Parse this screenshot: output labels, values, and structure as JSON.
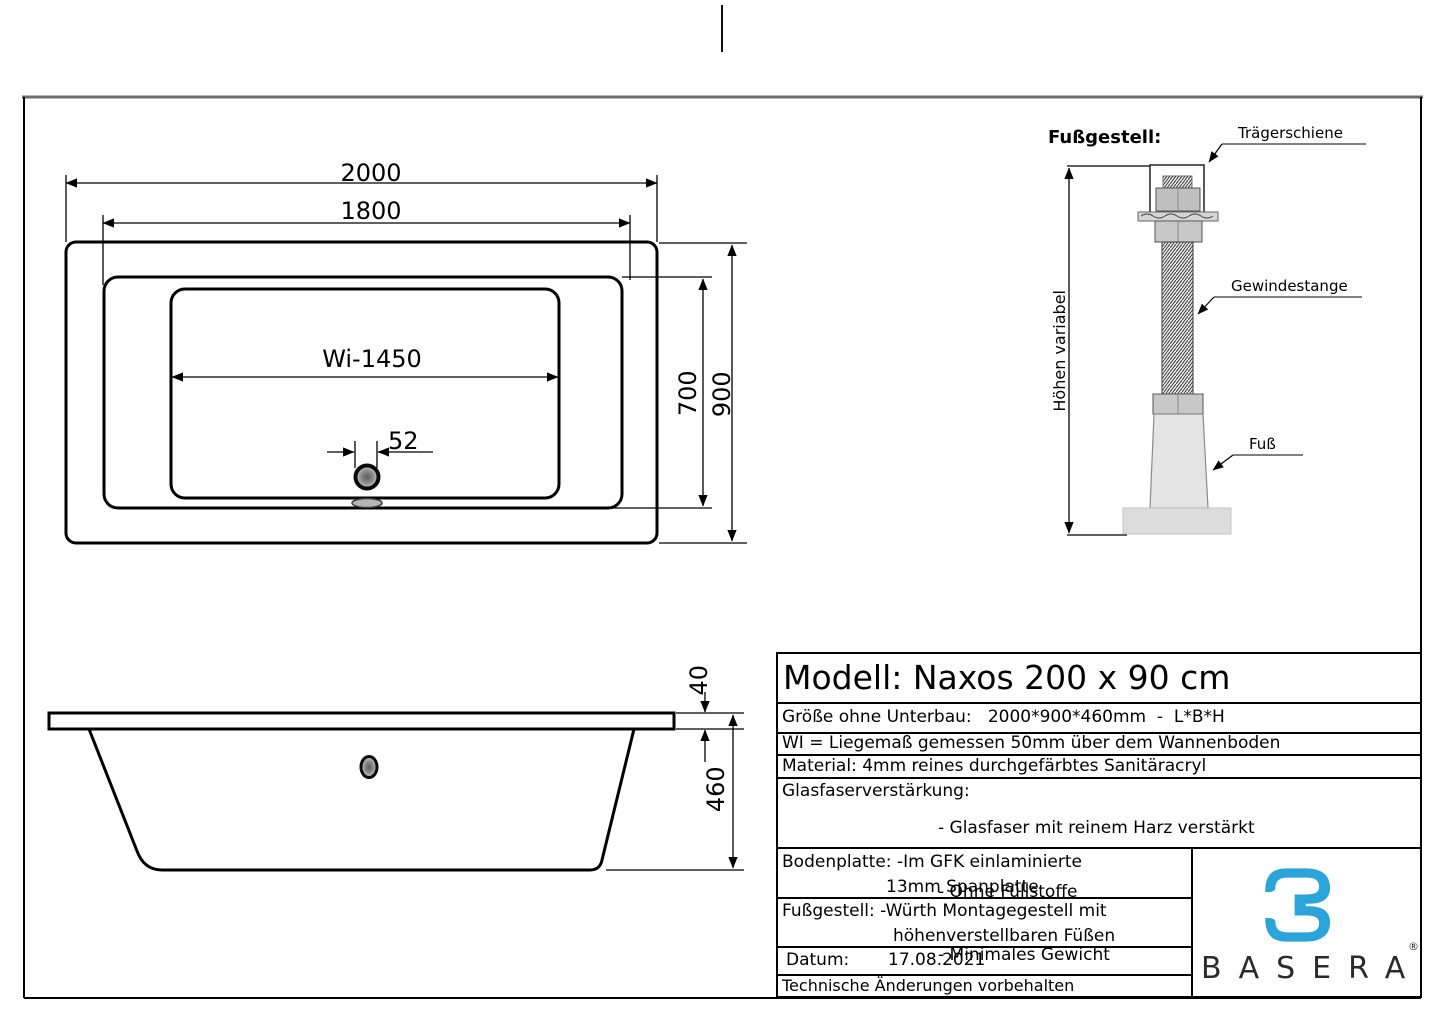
{
  "top_view": {
    "dim_outer_length": "2000",
    "dim_rim_length": "1800",
    "dim_lying": "Wi-1450",
    "dim_drain_offset": "52",
    "dim_inner_width": "700",
    "dim_outer_width": "900"
  },
  "side_view": {
    "dim_rim_height": "40",
    "dim_total_height": "460"
  },
  "foot_assembly": {
    "title": "Fußgestell:",
    "label_rail": "Trägerschiene",
    "label_threaded_rod": "Gewindestange",
    "label_foot": "Fuß",
    "label_height_variable": "Höhen variabel"
  },
  "title_block": {
    "model": "Modell: Naxos 200 x 90 cm",
    "size_row": "Größe ohne Unterbau:   2000*900*460mm  -  L*B*H",
    "wi_row": "WI = Liegemaß gemessen 50mm über dem Wannenboden",
    "material_row": "Material: 4mm reines durchgefärbtes Sanitäracryl",
    "fiberglass_label": "Glasfaserverstärkung:",
    "fiberglass_items": [
      "- Glasfaser mit reinem Harz verstärkt",
      "- Ohne Füllstoffe",
      "- Minimales Gewicht"
    ],
    "baseplate_line1": "Bodenplatte: -Im GFK einlaminierte",
    "baseplate_line2": "13mm Spanplatte",
    "footframe_line1": "Fußgestell: -Würth Montagegestell mit",
    "footframe_line2": "höhenverstellbaren Füßen",
    "date_label": "Datum:",
    "date_value": "17.08.2021",
    "revision_note": "Technische Änderungen vorbehalten",
    "brand": "BASERA",
    "brand_registered": "®",
    "brand_color": "#2aa4d9"
  }
}
